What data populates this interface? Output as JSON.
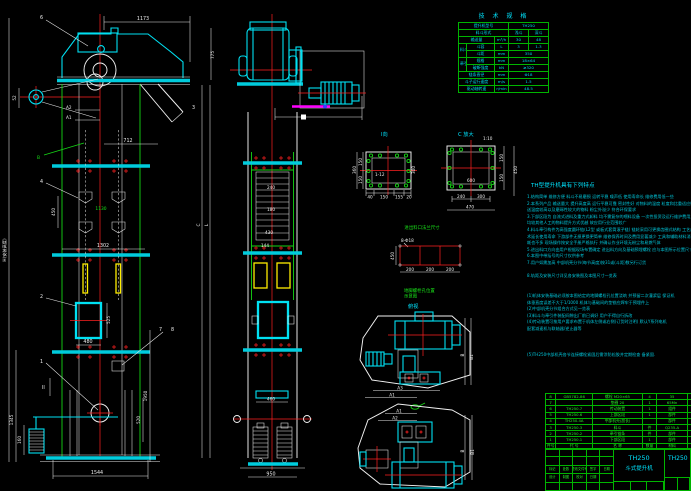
{
  "tech": {
    "title": "技 术 规 格",
    "r1l": "提升机型号",
    "r1v": "TH250",
    "r2l": "料斗形式",
    "r2a": "浅斗",
    "r2b": "深斗",
    "r3l": "输送量",
    "r3u": "m³/h",
    "r3a": "30",
    "r3b": "48",
    "g1": "料斗",
    "r4l": "斗容",
    "r4u": "L",
    "r4a": "3",
    "r4b": "1.3",
    "r5l": "斗距",
    "r5u": "mm",
    "r5v": "350",
    "g2": "牵引链",
    "r6l": "规格",
    "r6u": "mm",
    "r6v": "18×64",
    "r7l": "破断强度",
    "r7u": "kN",
    "r7v": "≥320",
    "r8l": "链条直径",
    "r8u": "mm",
    "r8v": "Φ18",
    "r9l": "斗子运行速度",
    "r9u": "m/s",
    "r9v": "1.5",
    "r10l": "驱动轴转速",
    "r10u": "r/min",
    "r10v": "48.5"
  },
  "features": {
    "title": "TH型提升机具有下列特点",
    "lines": [
      "1.结构简单 维修方便 料斗不易磨损 运转平稳 噪声低 使用寿命长 维修费用低一些",
      "2.本系列产品 输送量大 提升高度高 运行平稳可靠 密封性好 对物料的温度 粒度和比重适应性强 可输",
      "   送温度较高以及磨琢性较大的物料 粉尘外溢少 符合环保要求",
      "3.下部区段为 自流式进料及重力式卸料 均不需复杂的喂料设备 一次性投资及运行维护费用之间",
      "   均较其他人工的物料提升方式优越 故应用行业范围较广",
      "4.料斗牵引构件为高强度圆环链(L2型 或板式套筒滚子链) 链轮采用可更换齿圈式结构 工艺成熟的热处理技",
      "   术延长使用寿命 下游部件无损更换更简单 维修保养时间及费用显著减少 工具和辅助材料消",
      "   耗也不多 现场操作按安全手册严格执行 并确认作业环境无粉尘和易燃气体",
      "5.进出料口方向由用户根据现场布置确定 进出料方向及基础预埋螺栓 应与本图所示位置尺寸相符 订货时注",
      "6.本图中带括号的尺寸仅供参考",
      "7.用户如需加高 中部机壳分节(每节高度)按31或(斗距)数另行订货",
      "",
      "8.轨距及安装尺寸详见各安装图及本图尺寸一览表",
      "",
      "",
      "(1)机体安装基础必须按本图给定的地脚螺栓孔位置浇筑 并预留二次灌浆层 保证机",
      "体垂直度误差不大于1/1000 机体与基础间的垫铁应焊牢于预埋件上",
      "(2)中部机壳分节组合方式见一览表",
      "(3)料斗与牵引件装配间隙出厂前已调好 用户不得自行拆改",
      "(4)传动装置可按用户要求布置于机体左侧或右侧(订货时注明) 默认Y系列电机",
      "配套减速机与联轴器/逆止器等",
      "",
      "",
      "",
      "(5)TH250中部机壳各节连接螺栓紧固后需涂防松胶并定期检查 备紧固.",
      ""
    ]
  },
  "parts": {
    "h0": "件号",
    "h1": "代  号",
    "h2": "名  称",
    "h3": "数量",
    "h4": "材料",
    "h5": "单重",
    "rows": [
      {
        "no": "8",
        "code": "GB5782-86",
        "name": "螺栓 M20×65",
        "qty": "4",
        "mat": "35",
        "wt": ""
      },
      {
        "no": "7",
        "code": "",
        "name": "垫圈 20",
        "qty": "1",
        "mat": "65Mn",
        "wt": "0.03"
      },
      {
        "no": "6",
        "code": "TH250.7",
        "name": "传动装置",
        "qty": "1",
        "mat": "组件",
        "wt": ""
      },
      {
        "no": "5",
        "code": "TH250.6",
        "name": "上部区段",
        "qty": "1",
        "mat": "部件",
        "wt": ""
      },
      {
        "no": "4",
        "code": "TH250.4A",
        "name": "中部机壳(加长)",
        "qty": "",
        "mat": "部件",
        "wt": ""
      },
      {
        "no": "3",
        "code": "TH250.3",
        "name": "料斗",
        "qty": "件",
        "mat": "Q235-A",
        "wt": "206"
      },
      {
        "no": "2",
        "code": "TH250.2",
        "name": "牵引链条",
        "qty": "件",
        "mat": "部件",
        "wt": ""
      },
      {
        "no": "1",
        "code": "TH250.1",
        "name": "下部区段",
        "qty": "1",
        "mat": "部件",
        "wt": ""
      }
    ]
  },
  "tblock": {
    "model": "TH250",
    "product": "斗式提升机",
    "dwg_no": "TH250",
    "sig1": [
      "标记",
      "处数",
      "更改文件号",
      "签字",
      "日期"
    ],
    "sig2": [
      "设计",
      "制图",
      "校对",
      "日期"
    ]
  },
  "dims": {
    "d1173": "1173",
    "d712": "712",
    "d775": "775",
    "d450": "450",
    "d1130": "1130",
    "d1302": "1302",
    "d480": "480",
    "d525": "525",
    "d1345": "1345",
    "d160": "160",
    "d1950": "1950",
    "d520": "520",
    "d1544": "1544",
    "d52": "52",
    "dH": "H(安装高度)",
    "dC": "C",
    "dL": "L",
    "p1": "1",
    "p2": "2",
    "p3": "3",
    "p4": "4",
    "p6": "6",
    "p7": "7",
    "p8": "8",
    "a1": "A1",
    "a2": "A2",
    "sec2": "II",
    "bgreen": "B",
    "m240": "240",
    "m180": "180",
    "m430": "430",
    "m144": "144",
    "m460": "460",
    "m950": "950",
    "iTitle": "I向",
    "iInner": "1-12",
    "i150a": "150",
    "i150b": "150",
    "i360": "360",
    "i300": "300",
    "i40": "40",
    "i150c": "150",
    "i155": "155",
    "i20": "20",
    "cTitle": "C 放大",
    "cScale": "1:10",
    "c600": "600",
    "c240": "240",
    "c300": "300",
    "c470": "470",
    "c150a": "150",
    "c150b": "150",
    "c450": "450",
    "flangeCap": "进出料口法兰尺寸",
    "rHoles": "8-Φ18",
    "r450": "450",
    "r200a": "200",
    "r200b": "200",
    "r200c": "200",
    "rCap1": "地脚螺栓孔位置",
    "rCap2": "示意图",
    "pvCap": "俯视",
    "pvB": "B",
    "pvB1": "B1",
    "pvA3": "A3",
    "pvA1": "A1",
    "pbA1": "A1",
    "pbA2": "A2",
    "pbB": "B",
    "pbB1": "B1"
  }
}
